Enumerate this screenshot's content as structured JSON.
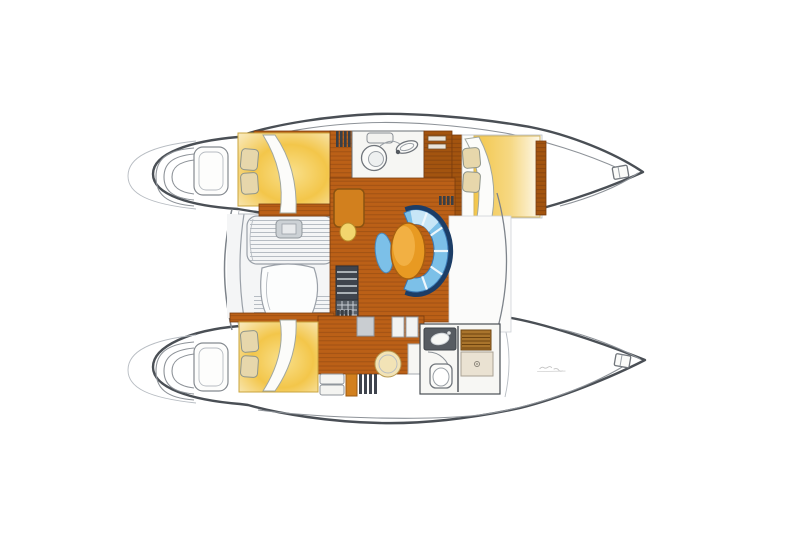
{
  "document": {
    "kind": "boat floor plan illustration",
    "subject": "sailing catamaran interior layout, top-down plan view, bows pointing right",
    "background": "#ffffff",
    "canvas": {
      "width": 800,
      "height": 533
    }
  },
  "palette": {
    "paper": "#ffffff",
    "hull_outline": "#4a4f55",
    "wood_floor": "#bb6017",
    "wood_plank_line": "#8a4511",
    "wood_dark": "#a3540f",
    "bed_yellow": "#f3c64a",
    "bed_glow_light": "#f9e08c",
    "bed_glow_pale": "#f9ecc4",
    "pillow": "#e7d7ab",
    "settee_navy": "#1c3d66",
    "settee_blue": "#7cc0e8",
    "settee_highlight": "#cfeaf8",
    "table_orange": "#e89a22",
    "table_highlight": "#f3b449",
    "desk_orange": "#d2801e",
    "stool_yellow": "#f2d66e",
    "cockpit_bg": "#f4f5f6",
    "cockpit_slat_line": "#b6bcc3",
    "counter_dark": "#575c62",
    "teak_grate": "#a9742c",
    "shower_pan": "#eae2d2",
    "stair_dark": "#3f444d",
    "stair_grid": "#596068",
    "stool_cream": "#f2e3b6",
    "fixture_white": "#fbfbf9"
  },
  "rooms": [
    {
      "id": "port-aft-cabin",
      "label": "double berth cabin, port aft"
    },
    {
      "id": "port-head",
      "label": "head with washbasin, port amidships"
    },
    {
      "id": "port-forward-cabin",
      "label": "double berth cabin, port forward"
    },
    {
      "id": "saloon",
      "label": "saloon with curved blue settee and oval table"
    },
    {
      "id": "nav-station",
      "label": "chart desk with stool"
    },
    {
      "id": "companionway-stairs",
      "label": "steps down into hulls"
    },
    {
      "id": "cockpit",
      "label": "aft cockpit with slatted bench seating"
    },
    {
      "id": "starboard-aft-cabin",
      "label": "double berth cabin, starboard aft"
    },
    {
      "id": "starboard-head",
      "label": "head with shower and teak grate, starboard forward"
    },
    {
      "id": "transom-steps",
      "label": "swim steps on both transoms"
    },
    {
      "id": "bow-fittings",
      "label": "anchor/cleat fittings at both bow tips"
    }
  ],
  "annotations": {
    "signature": {
      "legible": false,
      "note": "tiny faint designer signature inside starboard bow"
    }
  }
}
